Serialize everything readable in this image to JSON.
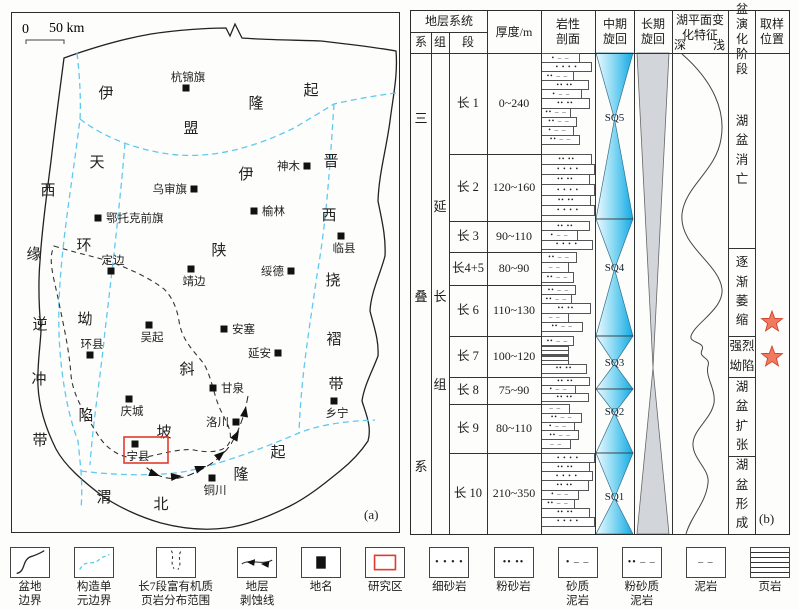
{
  "colors": {
    "tect_blue": "#5fc9f0",
    "cycle_blue_light": "#eef9fe",
    "cycle_blue_dark": "#12a9e4",
    "long_cycle_gray": "#d2d6db",
    "star_fill": "#f07a5e",
    "star_stroke": "#cf3b23",
    "study_red": "#e23b2e"
  },
  "figure": {
    "panel_a_label": "(a)",
    "panel_b_label": "(b)"
  },
  "map": {
    "scale_bar": {
      "zero": "0",
      "label": "50 km"
    },
    "cities": [
      {
        "name": "杭锦旗",
        "x": 174,
        "y": 75,
        "side": "above"
      },
      {
        "name": "神木",
        "x": 295,
        "y": 153,
        "side": "left"
      },
      {
        "name": "乌审旗",
        "x": 182,
        "y": 176,
        "side": "left"
      },
      {
        "name": "鄂托克前旗",
        "x": 86,
        "y": 205,
        "side": "right"
      },
      {
        "name": "榆林",
        "x": 242,
        "y": 198,
        "side": "right"
      },
      {
        "name": "临县",
        "x": 329,
        "y": 223,
        "side": "below"
      },
      {
        "name": "定边",
        "x": 99,
        "y": 258,
        "side": "above"
      },
      {
        "name": "靖边",
        "x": 179,
        "y": 256,
        "side": "below"
      },
      {
        "name": "绥德",
        "x": 279,
        "y": 258,
        "side": "left"
      },
      {
        "name": "吴起",
        "x": 137,
        "y": 312,
        "side": "below"
      },
      {
        "name": "安塞",
        "x": 212,
        "y": 316,
        "side": "right"
      },
      {
        "name": "延安",
        "x": 266,
        "y": 340,
        "side": "left"
      },
      {
        "name": "环县",
        "x": 78,
        "y": 342,
        "side": "above"
      },
      {
        "name": "甘泉",
        "x": 201,
        "y": 375,
        "side": "right"
      },
      {
        "name": "庆城",
        "x": 117,
        "y": 386,
        "side": "below"
      },
      {
        "name": "洛川",
        "x": 224,
        "y": 409,
        "side": "left"
      },
      {
        "name": "乡宁",
        "x": 322,
        "y": 388,
        "side": "below"
      },
      {
        "name": "宁县",
        "x": 123,
        "y": 431,
        "side": "below",
        "boxed": true
      },
      {
        "name": "铜川",
        "x": 200,
        "y": 465,
        "side": "below"
      }
    ],
    "units": [
      {
        "name": "伊盟隆起",
        "chars": [
          [
            "伊",
            94,
            85
          ],
          [
            "盟",
            179,
            120
          ],
          [
            "隆",
            244,
            95
          ],
          [
            "起",
            299,
            82
          ]
        ]
      },
      {
        "name": "西缘逆冲带",
        "chars": [
          [
            "西",
            36,
            182
          ],
          [
            "缘",
            22,
            246
          ],
          [
            "逆",
            28,
            316
          ],
          [
            "冲",
            27,
            371
          ],
          [
            "带",
            28,
            432
          ]
        ]
      },
      {
        "name": "天环坳陷",
        "chars": [
          [
            "天",
            85,
            154
          ],
          [
            "环",
            72,
            237
          ],
          [
            "坳",
            73,
            311
          ],
          [
            "陷",
            74,
            407
          ]
        ]
      },
      {
        "name": "伊陕斜坡",
        "chars": [
          [
            "伊",
            234,
            166
          ],
          [
            "陕",
            207,
            242
          ],
          [
            "斜",
            175,
            361
          ],
          [
            "坡",
            152,
            424
          ]
        ]
      },
      {
        "name": "晋西挠褶带",
        "chars": [
          [
            "晋",
            319,
            153
          ],
          [
            "西",
            317,
            207
          ],
          [
            "挠",
            321,
            272
          ],
          [
            "褶",
            322,
            331
          ],
          [
            "带",
            324,
            376
          ]
        ]
      },
      {
        "name": "渭北隆起",
        "chars": [
          [
            "渭",
            92,
            489
          ],
          [
            "北",
            149,
            496
          ],
          [
            "隆",
            229,
            466
          ],
          [
            "起",
            266,
            444
          ]
        ]
      }
    ]
  },
  "column": {
    "header": {
      "strata": "地层系统",
      "system": "系",
      "group": "组",
      "member": "段",
      "thickness": "厚度/m",
      "lithology": "岩性剖面",
      "mid_cycle": "中期旋回",
      "long_cycle": "长期旋回",
      "lake_level": "湖平面变化特征",
      "deep": "深",
      "shallow": "浅",
      "evolution": "湖盆演化阶段",
      "sampling": "取样位置"
    },
    "system_chars": [
      [
        "三",
        105
      ],
      [
        "叠",
        283
      ],
      [
        "系",
        453
      ]
    ],
    "group_chars": [
      [
        "延",
        193
      ],
      [
        "长",
        283
      ],
      [
        "组",
        371
      ]
    ],
    "rows": [
      {
        "member": "长 1",
        "thickness": "0~240",
        "h": 101,
        "beds": [
          [
            "sandy",
            0.72
          ],
          [
            "fine",
            0.95
          ],
          [
            "siltym",
            0.6
          ],
          [
            "silt",
            0.88
          ],
          [
            "sandy",
            0.75
          ],
          [
            "silt",
            0.9
          ],
          [
            "siltym",
            0.55
          ],
          [
            "siltym",
            0.66
          ],
          [
            "sandy",
            0.6
          ],
          [
            "siltym",
            0.72
          ]
        ]
      },
      {
        "member": "长 2",
        "thickness": "120~160",
        "h": 67,
        "beds": [
          [
            "silt",
            0.95
          ],
          [
            "fine",
            1.0
          ],
          [
            "silt",
            0.9
          ],
          [
            "fine",
            1.0
          ],
          [
            "silt",
            0.93
          ],
          [
            "fine",
            1.0
          ]
        ]
      },
      {
        "member": "长 3",
        "thickness": "90~110",
        "h": 31,
        "beds": [
          [
            "silt",
            0.9
          ],
          [
            "sandy",
            0.68
          ],
          [
            "fine",
            0.96
          ]
        ]
      },
      {
        "member": "长4+5",
        "thickness": "80~90",
        "h": 33,
        "beds": [
          [
            "siltym",
            0.66
          ],
          [
            "mud",
            0.5
          ],
          [
            "siltym",
            0.6
          ]
        ]
      },
      {
        "member": "长 6",
        "thickness": "110~130",
        "h": 51,
        "beds": [
          [
            "siltym",
            0.64
          ],
          [
            "siltym",
            0.56
          ],
          [
            "silt",
            0.92
          ],
          [
            "mud",
            0.5
          ],
          [
            "siltym",
            0.78
          ]
        ]
      },
      {
        "member": "长 7",
        "thickness": "100~120",
        "h": 41,
        "beds": [
          [
            "siltym",
            0.6
          ],
          [
            "shale",
            0.5
          ],
          [
            "shale",
            0.5
          ],
          [
            "silt",
            0.85
          ]
        ]
      },
      {
        "member": "长 8",
        "thickness": "75~90",
        "h": 27,
        "beds": [
          [
            "silt",
            0.9
          ],
          [
            "sandy",
            0.64
          ],
          [
            "silt",
            0.88
          ]
        ]
      },
      {
        "member": "长 9",
        "thickness": "80~110",
        "h": 49,
        "beds": [
          [
            "mud",
            0.52
          ],
          [
            "siltym",
            0.76
          ],
          [
            "sandy",
            0.62
          ],
          [
            "siltym",
            0.7
          ],
          [
            "mud",
            0.55
          ]
        ]
      },
      {
        "member": "长 10",
        "thickness": "210~350",
        "h": 81,
        "beds": [
          [
            "fine",
            1.0
          ],
          [
            "silt",
            0.9
          ],
          [
            "fine",
            0.96
          ],
          [
            "silt",
            0.88
          ],
          [
            "sandy",
            0.7
          ],
          [
            "siltym",
            0.62
          ],
          [
            "silt",
            0.9
          ],
          [
            "fine",
            1.0
          ]
        ]
      }
    ],
    "lith_patterns": {
      "fine": "• • • •",
      "silt": "•• ••",
      "sandy": "• – –",
      "siltym": "•• – –",
      "mud": "– –",
      "shale": ""
    },
    "cycles": {
      "sq_labels": [
        {
          "t": "SQ5",
          "y": 108
        },
        {
          "t": "SQ4",
          "y": 258
        },
        {
          "t": "SQ3",
          "y": 353
        },
        {
          "t": "SQ2",
          "y": 402
        },
        {
          "t": "SQ1",
          "y": 487
        }
      ],
      "mid_vertices": [
        42,
        108,
        208,
        258,
        325,
        353,
        378,
        402,
        442,
        487,
        523
      ],
      "long_pinch_y": 357
    },
    "stages": [
      {
        "label": "湖盆消亡",
        "y1": 42,
        "y2": 237,
        "cols": 1
      },
      {
        "label": "逐渐萎缩",
        "y1": 237,
        "y2": 325,
        "cols": 1
      },
      {
        "label": "强烈坳陷",
        "y1": 325,
        "y2": 366,
        "cols": 2
      },
      {
        "label": "湖盆扩张",
        "y1": 366,
        "y2": 445,
        "cols": 1
      },
      {
        "label": "湖盆形成",
        "y1": 445,
        "y2": 523,
        "cols": 1
      }
    ],
    "stars_y": [
      311,
      346
    ]
  },
  "legend": [
    {
      "glyph": "basin",
      "label": "盆地\n边界"
    },
    {
      "glyph": "tect",
      "label": "构造单\n元边界"
    },
    {
      "glyph": "shale-area",
      "label": "长7段富有机质\n页岩分布范围"
    },
    {
      "glyph": "erosion",
      "label": "地层\n剥蚀线"
    },
    {
      "glyph": "place",
      "label": "地名"
    },
    {
      "glyph": "study",
      "label": "研究区"
    },
    {
      "glyph": "fine",
      "label": "细砂岩"
    },
    {
      "glyph": "silt",
      "label": "粉砂岩"
    },
    {
      "glyph": "sandy",
      "label": "砂质\n泥岩"
    },
    {
      "glyph": "siltym",
      "label": "粉砂质\n泥岩"
    },
    {
      "glyph": "mud",
      "label": "泥岩"
    },
    {
      "glyph": "shale",
      "label": "页岩"
    }
  ]
}
